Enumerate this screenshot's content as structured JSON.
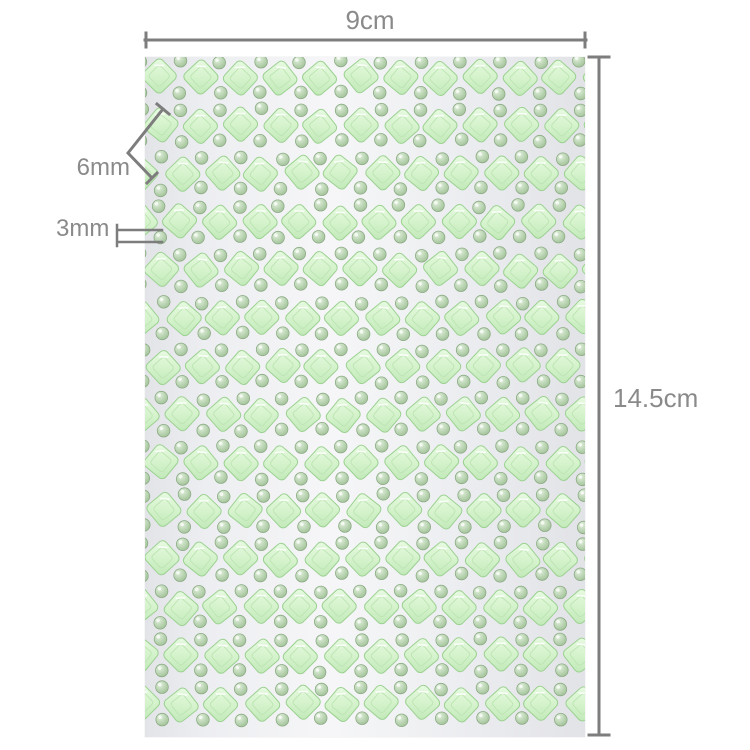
{
  "title": "Self-adhesive rhinestone gem sticker sheet dimension diagram",
  "annotations": {
    "sheet_width": {
      "label": "9cm"
    },
    "sheet_height": {
      "label": "14.5cm"
    },
    "diamond_gem": {
      "label": "6mm"
    },
    "round_gem": {
      "label": "3mm"
    },
    "line_color": "#7d7d7d",
    "text_color": "#8a8a8a"
  },
  "sheet": {
    "rows": 14,
    "cols": 11,
    "row_spacing": 48.2,
    "col_spacing": 40,
    "top_margin": 20,
    "row_offset_a": 16,
    "row_offset_b": -3,
    "background_left": "#e3e4e8",
    "background_center": "#f6f6f8",
    "background_right": "#e2e3e7",
    "diamond": {
      "size": 40,
      "side": 27,
      "corner_radius": 5,
      "edge_color": "#9cd192",
      "facet_color": "#bce3b3",
      "fill_light": "#e9fbe3",
      "fill_mid": "#d3f2ca",
      "fill_dark": "#c0e8b7"
    },
    "round": {
      "radius": 6.3,
      "edge_color": "#8cab85",
      "fill_light": "#e0efdb",
      "fill_mid": "#b0cda8",
      "fill_dark": "#96b78e"
    }
  }
}
